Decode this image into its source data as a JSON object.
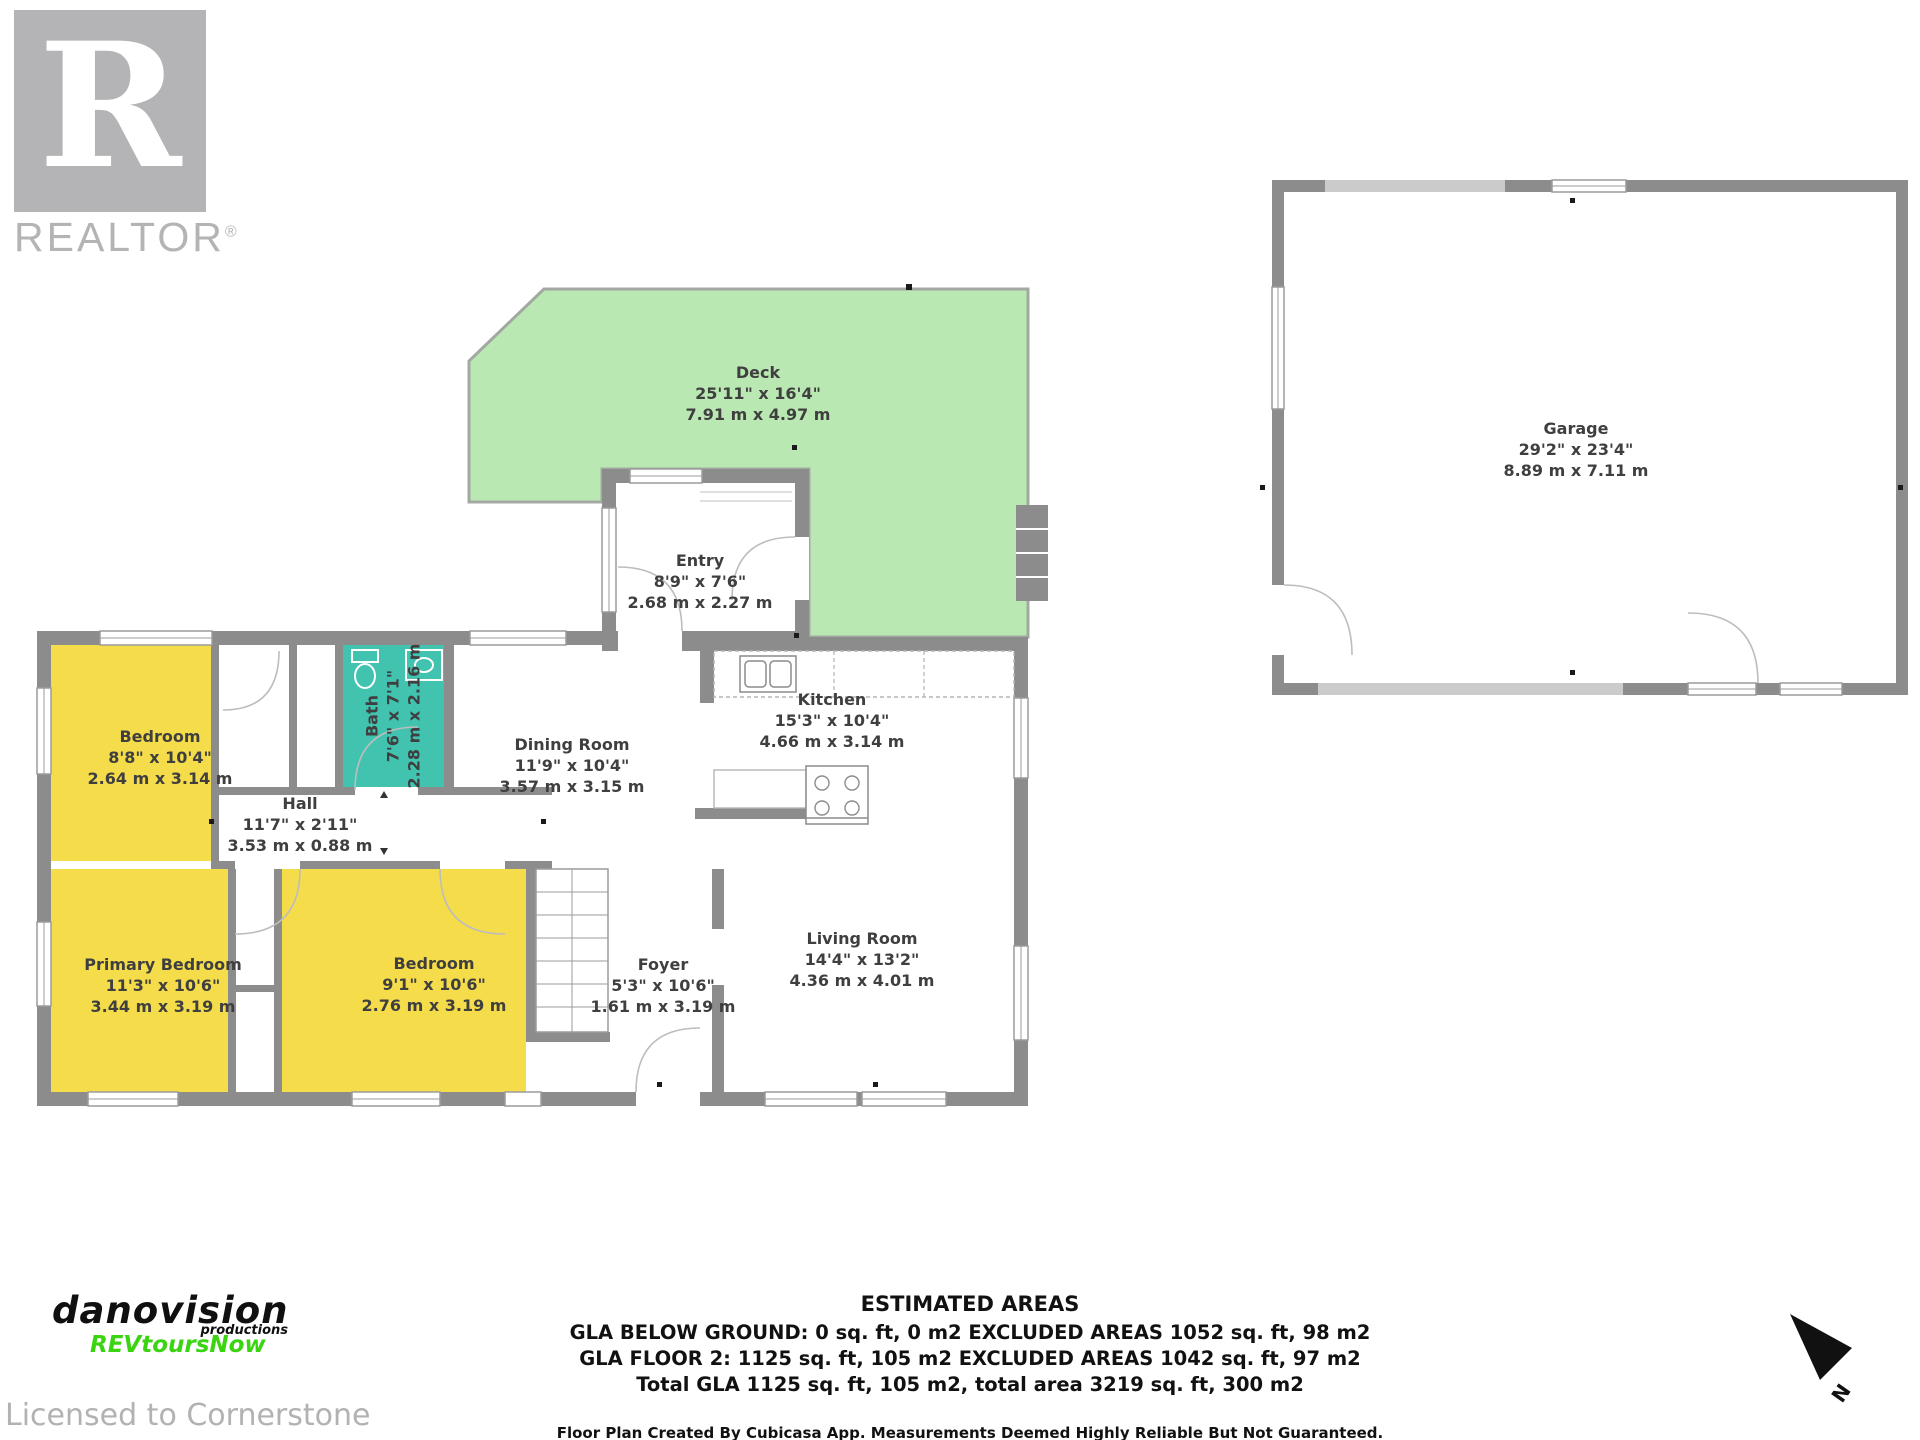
{
  "branding": {
    "realtor_letter": "R",
    "realtor_word": "REALTOR",
    "registered_mark": "®",
    "danovision": "danovision",
    "productions": "productions",
    "revtours": "REVtoursNow",
    "licensed_to": "Licensed to Cornerstone"
  },
  "rooms": [
    {
      "name": "Deck",
      "imperial": "25'11\" x 16'4\"",
      "metric": "7.91 m x 4.97 m"
    },
    {
      "name": "Entry",
      "imperial": "8'9\" x 7'6\"",
      "metric": "2.68 m x 2.27 m"
    },
    {
      "name": "Garage",
      "imperial": "29'2\" x 23'4\"",
      "metric": "8.89 m x 7.11 m"
    },
    {
      "name": "Bedroom",
      "imperial": "8'8\" x 10'4\"",
      "metric": "2.64 m x 3.14 m"
    },
    {
      "name": "Bath",
      "imperial": "7'6\" x 7'1\"",
      "metric": "2.28 m x 2.16 m"
    },
    {
      "name": "Dining Room",
      "imperial": "11'9\" x 10'4\"",
      "metric": "3.57 m x 3.15 m"
    },
    {
      "name": "Kitchen",
      "imperial": "15'3\" x 10'4\"",
      "metric": "4.66 m x 3.14 m"
    },
    {
      "name": "Hall",
      "imperial": "11'7\" x 2'11\"",
      "metric": "3.53 m x 0.88 m"
    },
    {
      "name": "Primary Bedroom",
      "imperial": "11'3\" x 10'6\"",
      "metric": "3.44 m x 3.19 m"
    },
    {
      "name": "Bedroom",
      "imperial": "9'1\" x 10'6\"",
      "metric": "2.76 m x 3.19 m"
    },
    {
      "name": "Foyer",
      "imperial": "5'3\" x 10'6\"",
      "metric": "1.61 m x 3.19 m"
    },
    {
      "name": "Living Room",
      "imperial": "14'4\" x 13'2\"",
      "metric": "4.36 m x 4.01 m"
    }
  ],
  "estimated_areas": {
    "title": "ESTIMATED AREAS",
    "line1": "GLA BELOW GROUND: 0 sq. ft, 0 m2 EXCLUDED AREAS 1052 sq. ft, 98 m2",
    "line2": "GLA FLOOR 2: 1125 sq. ft, 105 m2 EXCLUDED AREAS 1042 sq. ft, 97 m2",
    "line3": "Total GLA 1125 sq. ft, 105 m2, total area 3219 sq. ft, 300 m2",
    "disclaimer": "Floor Plan Created By Cubicasa App. Measurements Deemed Highly Reliable But Not Guaranteed."
  },
  "compass": {
    "label": "N"
  },
  "colors": {
    "wall_gray": "#8c8c8c",
    "deck_green": "#bae8b2",
    "bedroom_yellow": "#f5dc4b",
    "bath_teal": "#41c3b0",
    "label_text": "#3f3f3f",
    "revtours_green": "#3bd411",
    "logo_gray": "#b4b4b6"
  }
}
